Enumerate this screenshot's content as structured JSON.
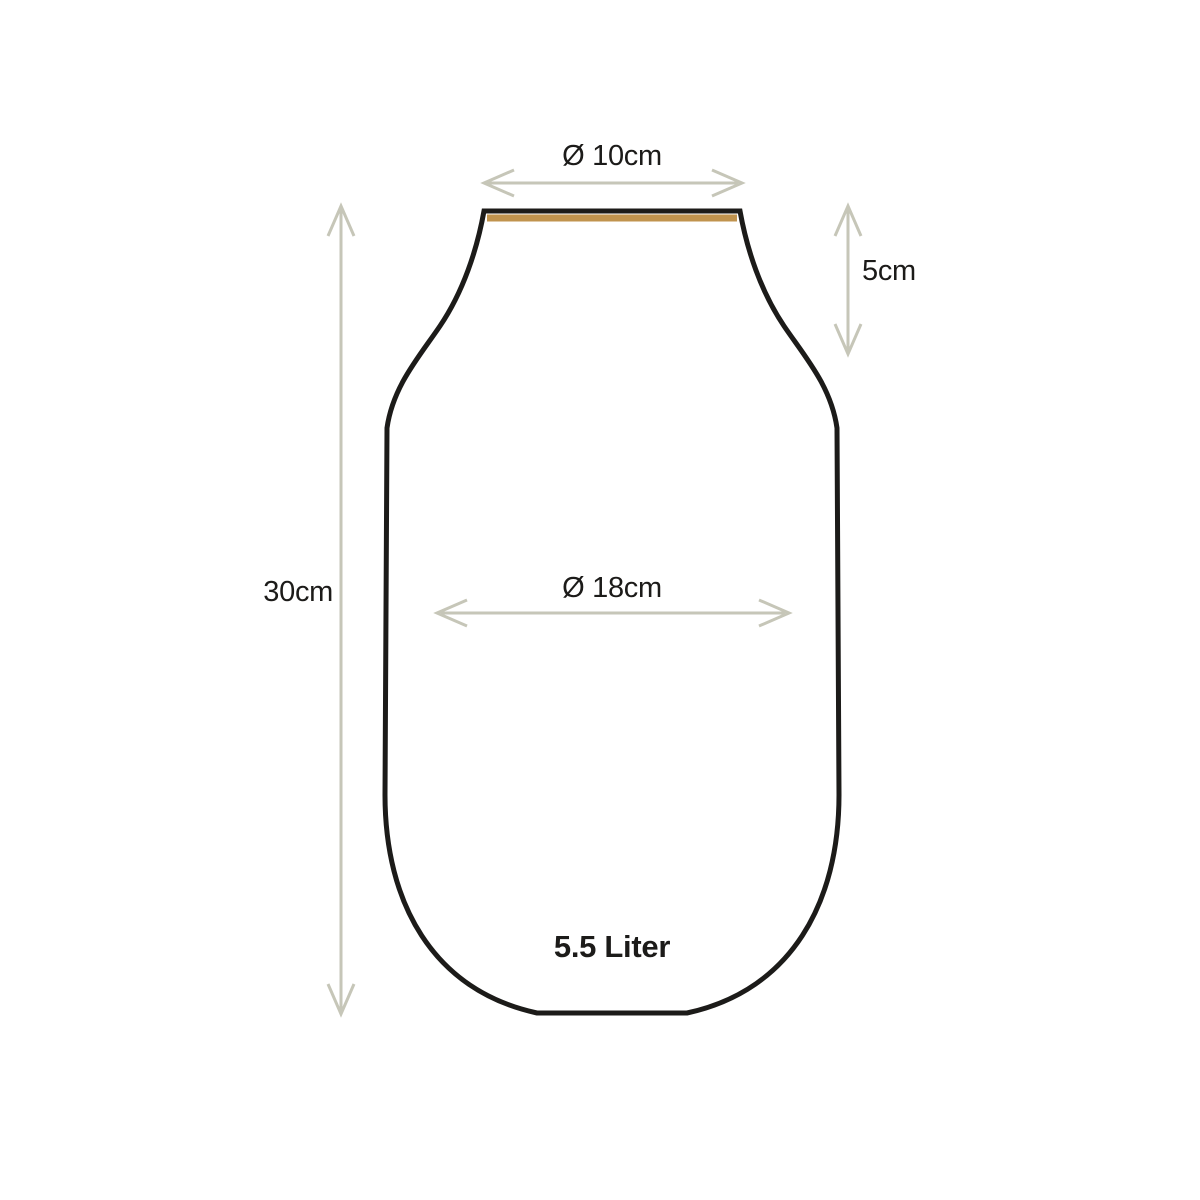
{
  "diagram": {
    "labels": {
      "top_diameter": "Ø 10cm",
      "neck_height": "5cm",
      "total_height": "30cm",
      "body_diameter": "Ø 18cm",
      "capacity": "5.5 Liter"
    },
    "colors": {
      "background": "#ffffff",
      "outline": "#1c1b19",
      "rim_accent": "#c0934e",
      "dimension_lines": "#c6c6b8",
      "text": "#1c1b19"
    }
  }
}
